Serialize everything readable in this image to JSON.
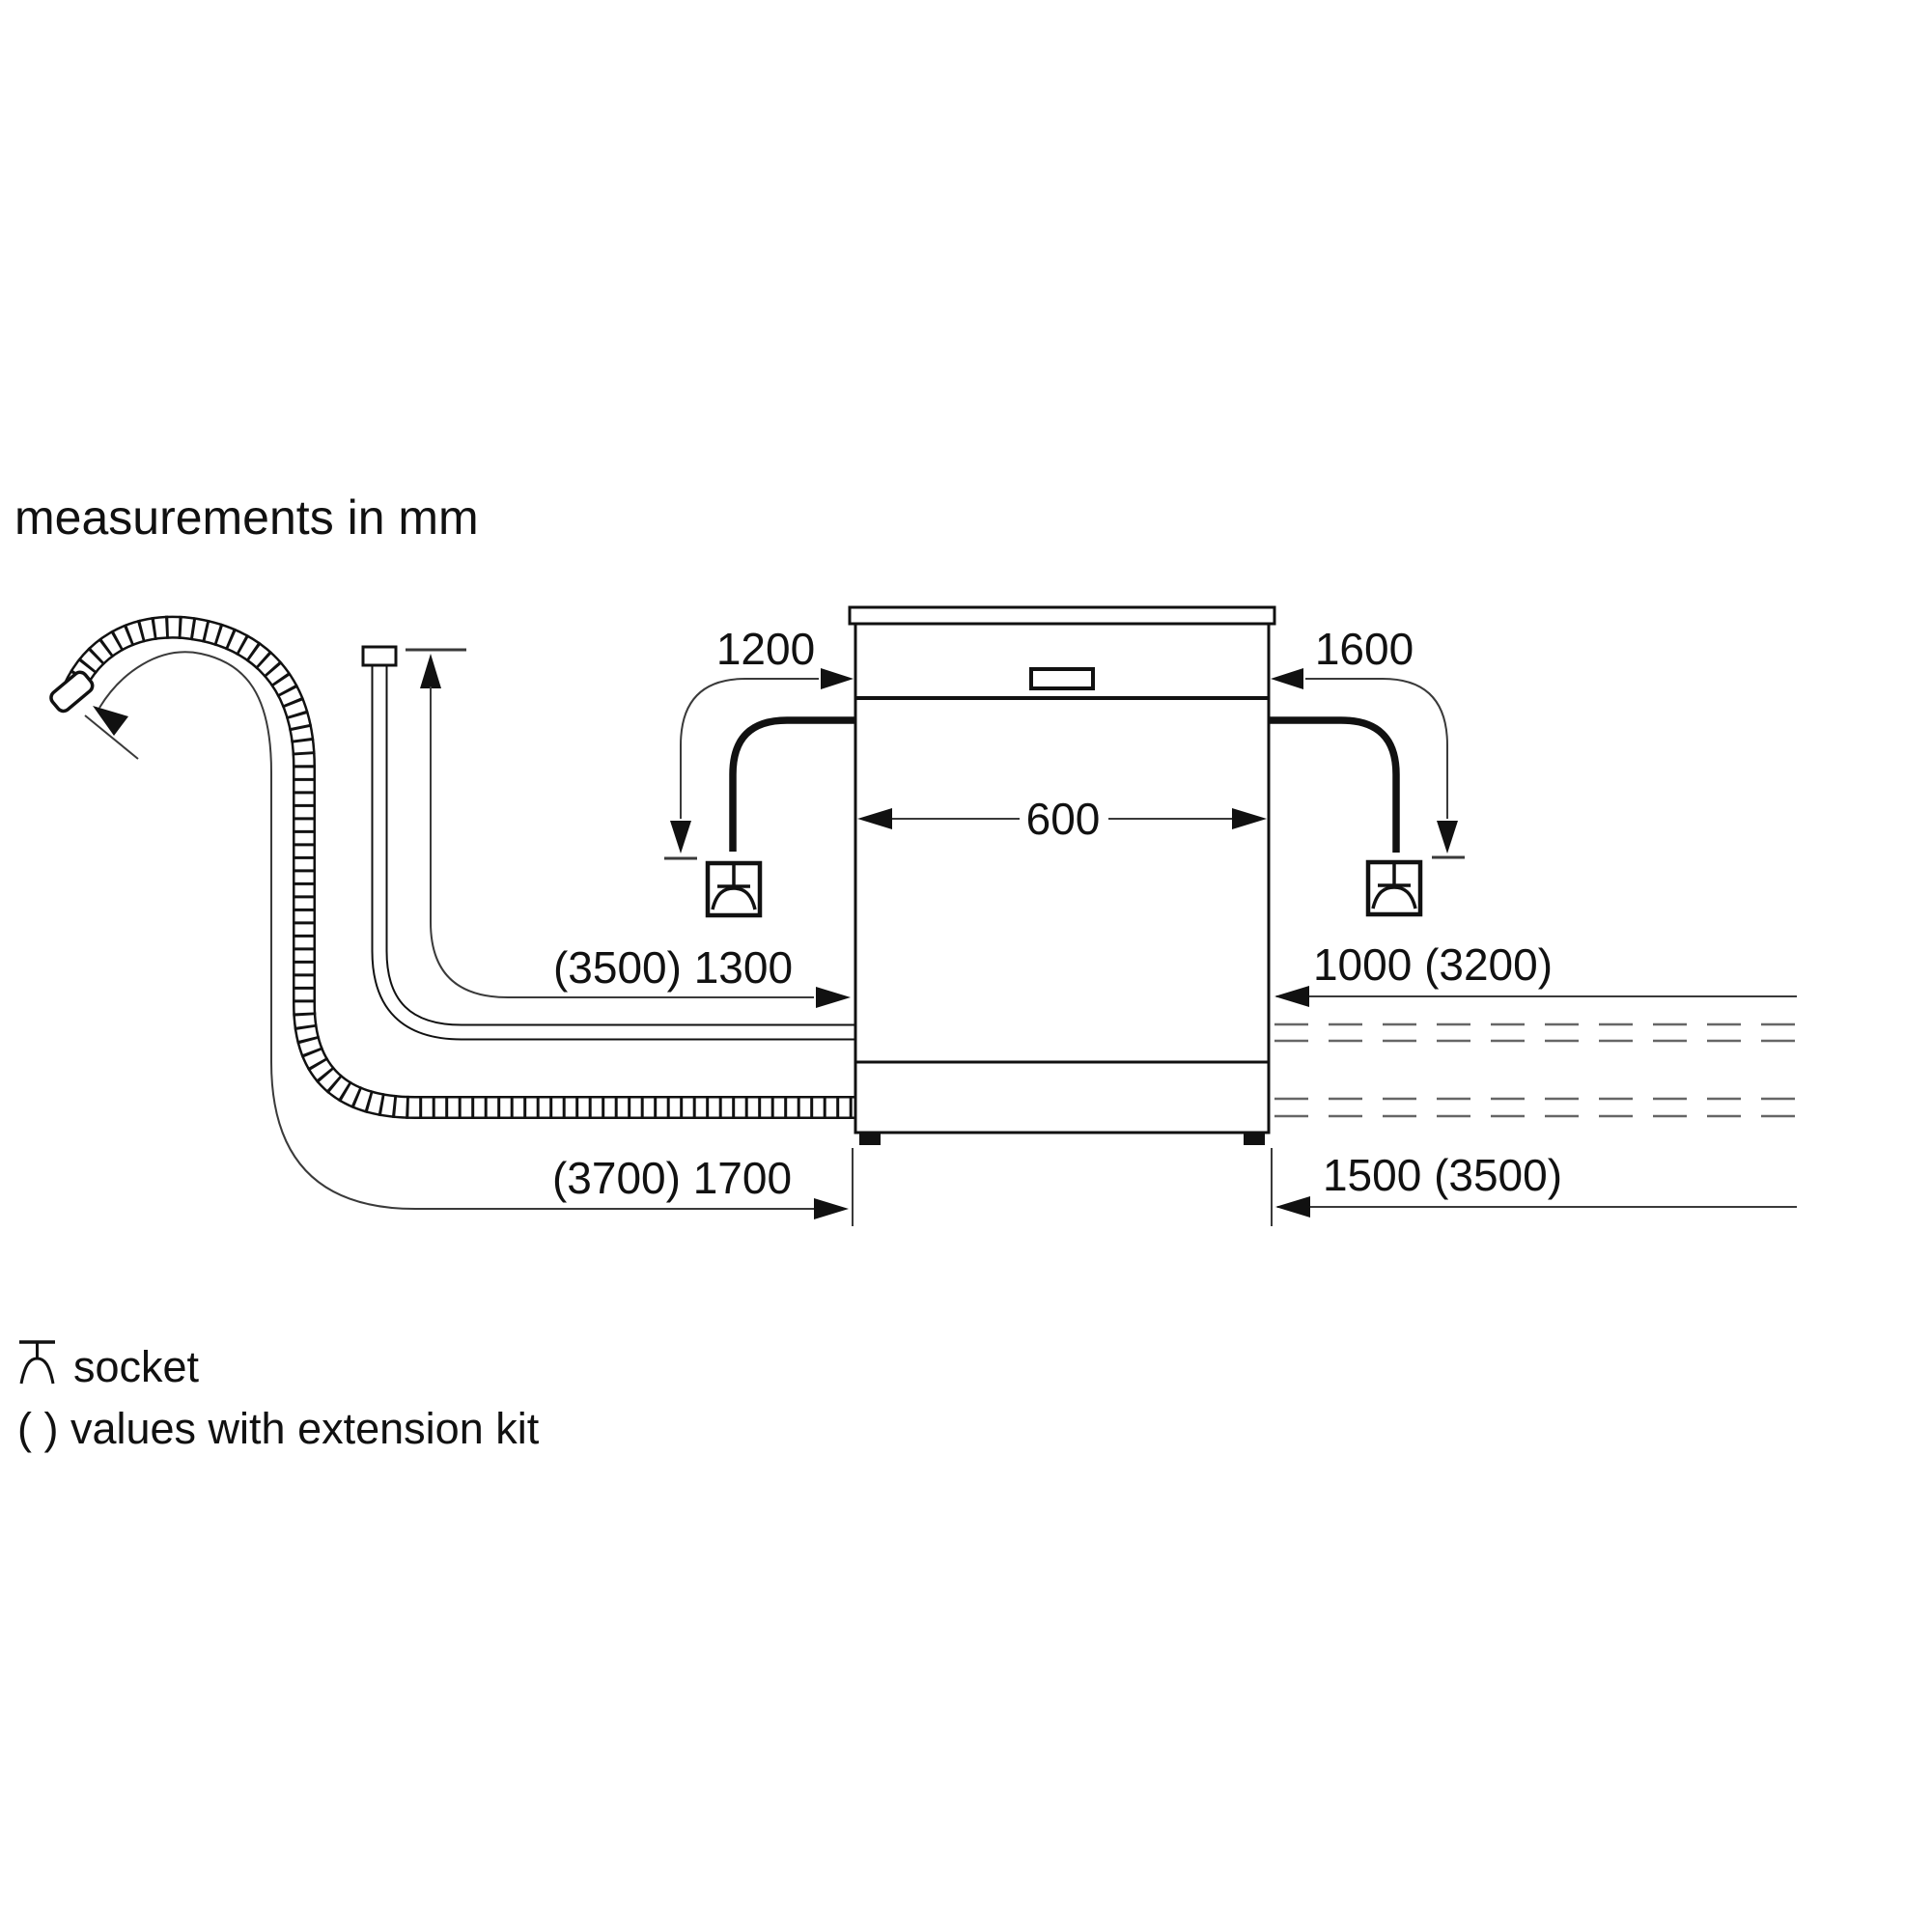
{
  "title": "measurements in mm",
  "dimensions": {
    "power_cord_left": "1200",
    "power_cord_right": "1600",
    "appliance_width": "600",
    "supply_hose_length": "(3500) 1300",
    "right_upper_length": "1000 (3200)",
    "drain_hose_length": "(3700) 1700",
    "right_lower_length": "1500 (3500)"
  },
  "legend": {
    "socket_label": "socket",
    "extension_label": "( ) values with extension kit"
  },
  "icons": {
    "socket_symbol": "schuko-socket-schematic",
    "drain_hose": "corrugated-hose",
    "supply_hose": "smooth-hose",
    "power_cord": "thick-cable"
  },
  "colors": {
    "background": "#ffffff",
    "line_black": "#111111",
    "dimension_line": "#3a3a3a",
    "dashed_line": "#666666",
    "text": "#111111"
  }
}
